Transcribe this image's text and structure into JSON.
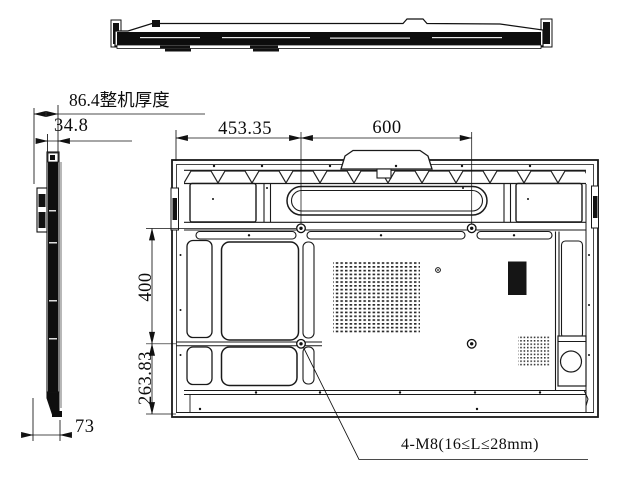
{
  "drawing": {
    "dims": {
      "overall_thickness": "86.4整机厚度",
      "body_thickness": "34.8",
      "edge_to_vesa": "453.35",
      "vesa_width": "600",
      "vesa_height": "400",
      "vesa_to_bottom": "263.83",
      "bottom_depth": "73",
      "mount_screw_spec": "4-M8(16≤L≤28mm)"
    }
  }
}
